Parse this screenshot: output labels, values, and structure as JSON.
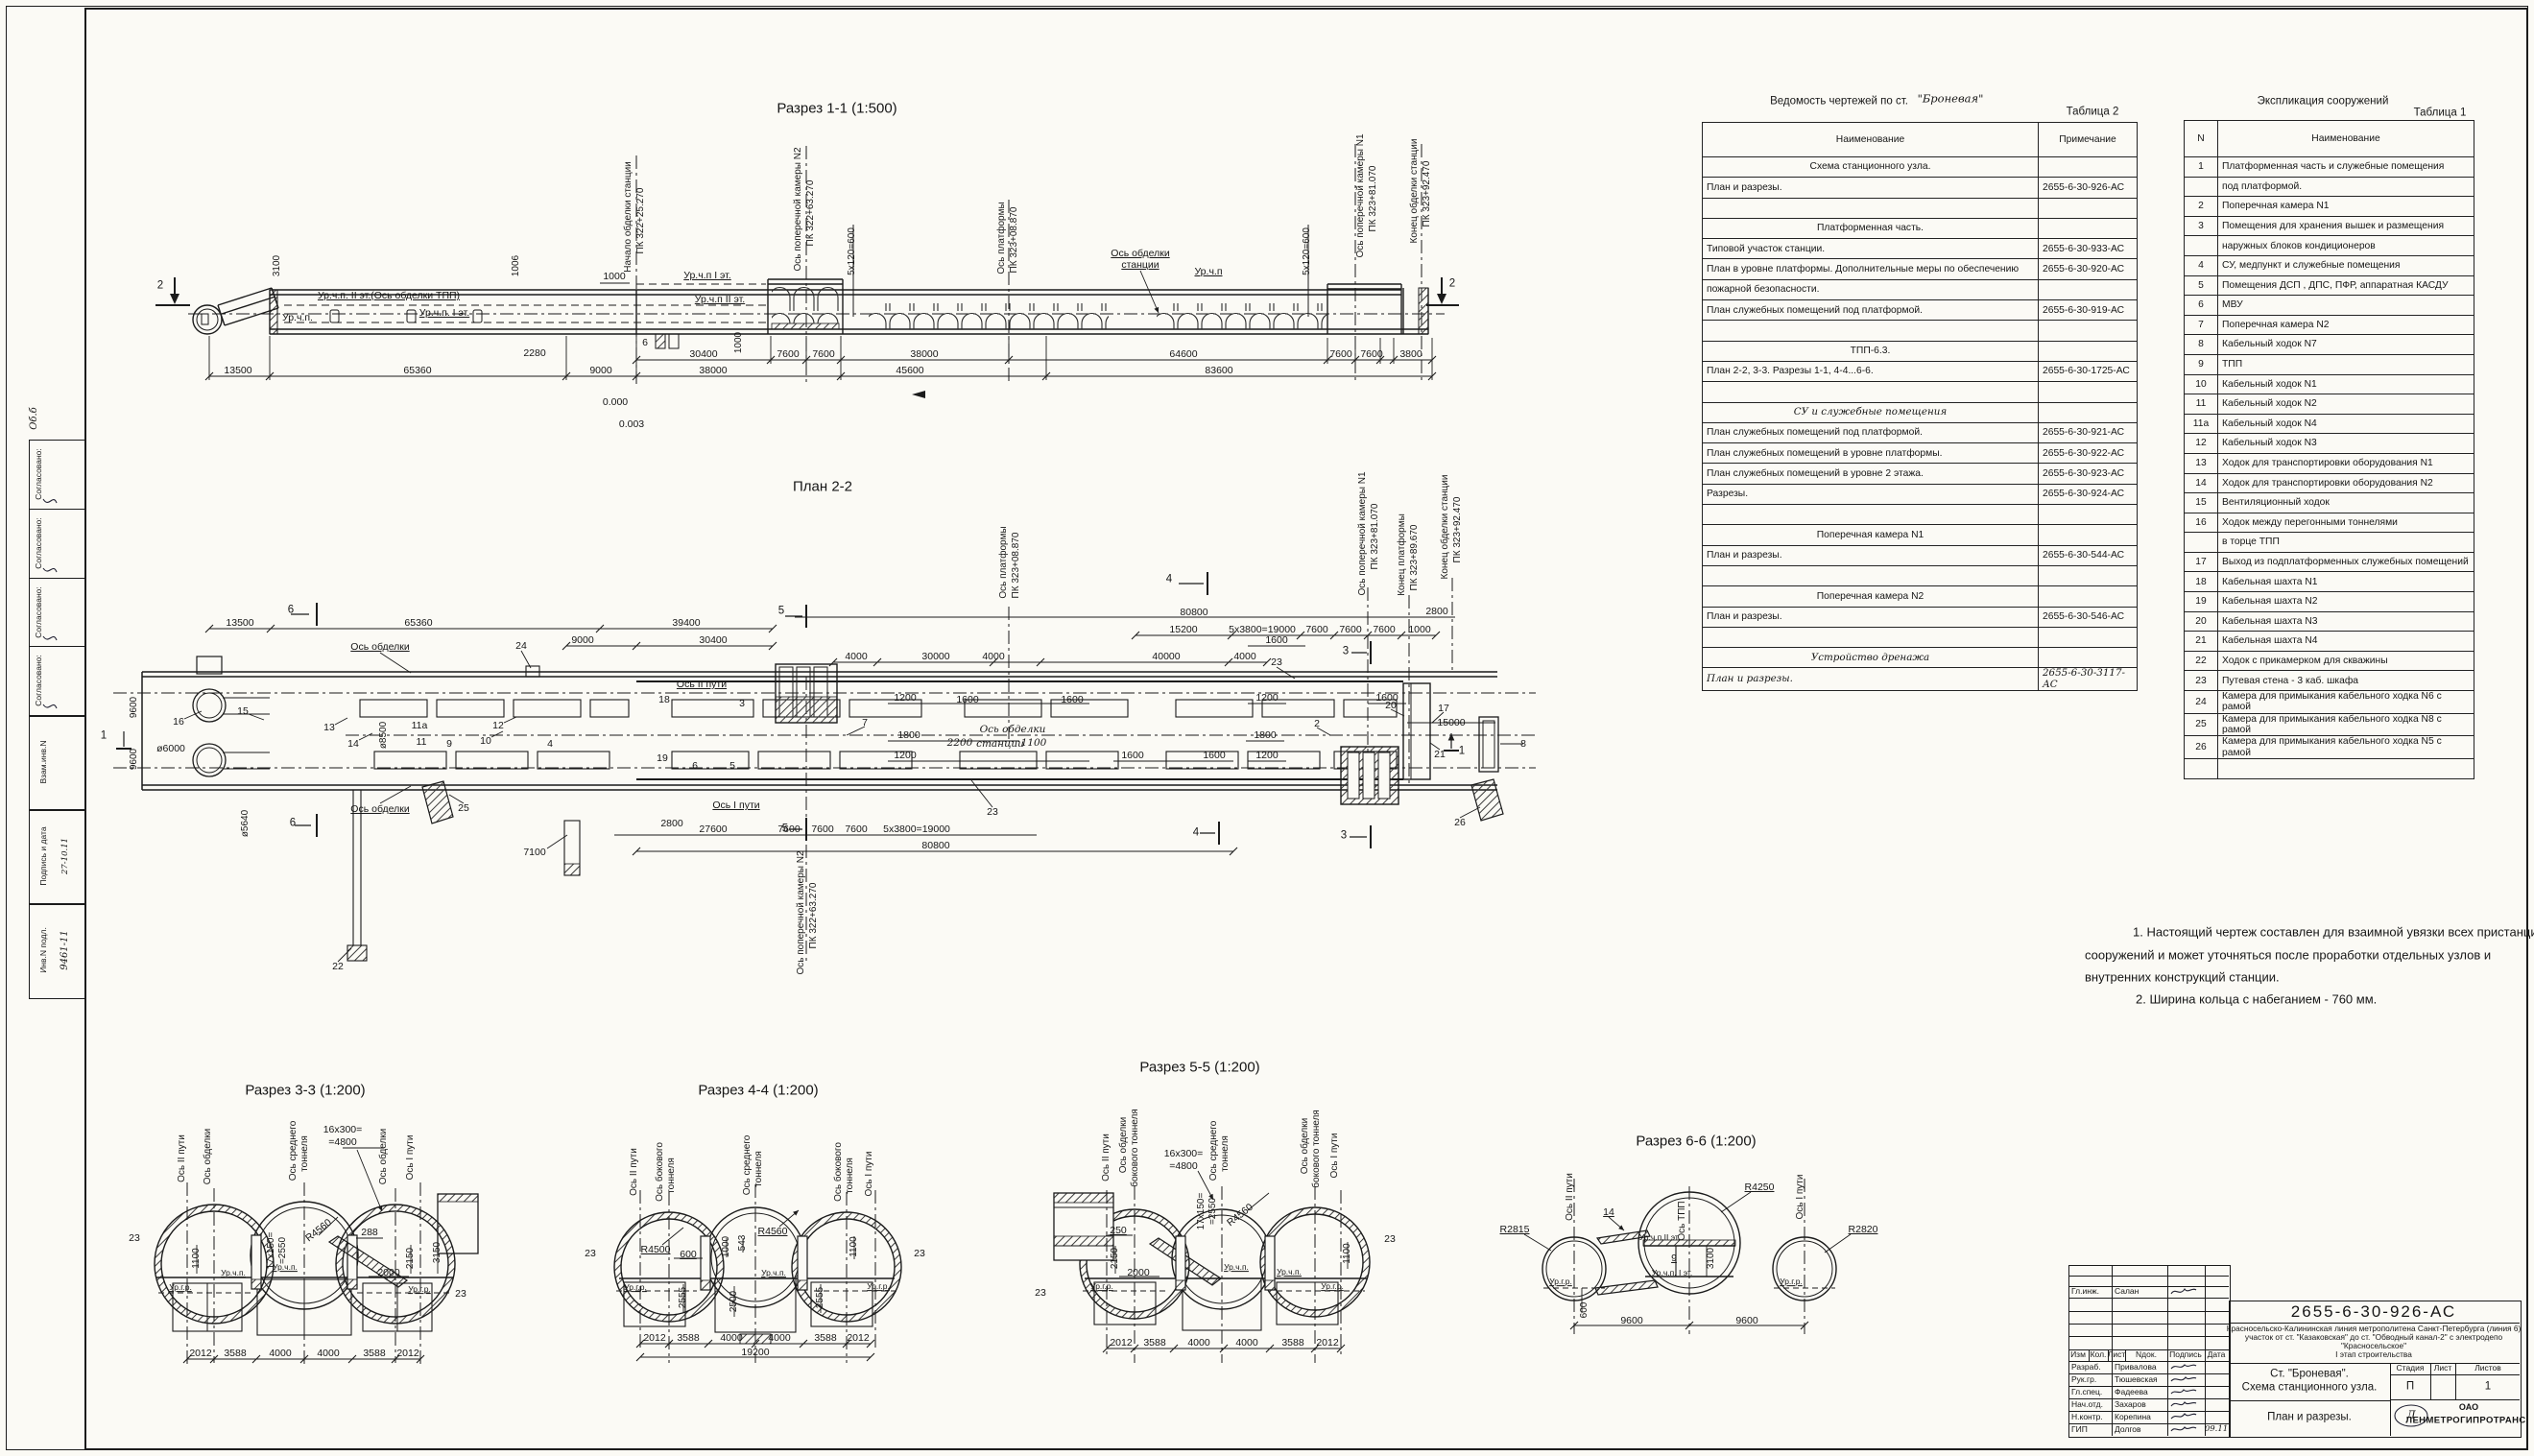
{
  "margin": {
    "agreed": "Согласовано:",
    "vzam": "Взам.инв.N",
    "sig": "Подпись и дата",
    "inv": "Инв.N подл.",
    "inv_no": "9461-11",
    "sig_date": "27-10.11",
    "scr": "Об.б"
  },
  "s11": {
    "t": "Разрез 1-1 (1:500)",
    "l": [
      "2",
      "2",
      "Ур.ч.п. II эт.(Ось обделки ТПП)",
      "Ур.ч.п.",
      "Ур.ч.п. I эт.",
      "Ур.ч.п I эт.",
      "Ур.ч.п II эт.",
      "6",
      "Ось обделки",
      "станции",
      "Ур.ч.п",
      "0.000",
      "0.003",
      "1000",
      "2280"
    ],
    "v": [
      "3100",
      "1006",
      "Начало обделки станции",
      "ПК 322+25.270",
      "Ось поперечной камеры N2",
      "ПК 322+63.270",
      "5х120=600",
      "Ось платформы",
      "ПК 323+08.870",
      "1000",
      "5х120=600",
      "Ось поперечной камеры N1",
      "ПК 323+81.070",
      "Конец обделки станции",
      "ПК 323+92.470"
    ],
    "du": [
      "30400",
      "7600",
      "7600",
      "38000",
      "64600",
      "7600",
      "7600",
      "3800"
    ],
    "dl": [
      "13500",
      "65360",
      "9000",
      "38000",
      "45600",
      "83600"
    ]
  },
  "p22": {
    "t": "План 2-2",
    "cut": [
      "6",
      "6",
      "5",
      "5",
      "4",
      "4",
      "3",
      "3",
      "1",
      "1"
    ],
    "n": [
      "16",
      "15",
      "13",
      "14",
      "11а",
      "11",
      "9",
      "12",
      "10",
      "4",
      "24",
      "25",
      "22",
      "18",
      "19",
      "6",
      "5",
      "3",
      "7",
      "23",
      "23",
      "20",
      "17",
      "2",
      "21",
      "26",
      "8"
    ],
    "l": [
      "Ось обделки",
      "Ось обделки",
      "Ось II пути",
      "Ось I пути",
      "ø6000",
      "7100",
      "15000"
    ],
    "h": [
      "Ось  обделки",
      "станции",
      "2200",
      "1100"
    ],
    "v": [
      "9600",
      "9600",
      "ø5640",
      "ø8500",
      "Ось платформы",
      "ПК 323+08.870",
      "Ось поперечной камеры N1",
      "ПК 323+81.070",
      "Конец платформы",
      "ПК 323+89.670",
      "Конец обделки станции",
      "ПК 323+92.470",
      "Ось поперечной камеры N2",
      "ПК 322+63.270"
    ],
    "d0": [
      "80800",
      "2800"
    ],
    "d1": [
      "13500",
      "65360",
      "39400",
      "15200",
      "5х3800=19000",
      "7600",
      "7600",
      "7600",
      "1000"
    ],
    "d2": [
      "9000",
      "30400",
      "1600"
    ],
    "d3": [
      "4000",
      "30000",
      "4000",
      "40000",
      "4000"
    ],
    "d4": [
      "1200",
      "1600",
      "1600",
      "1200",
      "1600"
    ],
    "d5": [
      "1800",
      "1800"
    ],
    "d6": [
      "1200",
      "1600",
      "1600",
      "1200"
    ],
    "d7": [
      "2800",
      "27600",
      "7600",
      "7600",
      "7600",
      "5х3800=19000",
      "80800"
    ]
  },
  "s33": {
    "t": "Разрез 3-3 (1:200)",
    "v": [
      "Ось II пути",
      "Ось обделки",
      "Ось среднего",
      "тоннеля",
      "Ось обделки",
      "Ось I пути",
      "1100",
      "17х150=",
      "=2550",
      "2150",
      "3150"
    ],
    "l": [
      "16х300=",
      "=4800",
      "R4560",
      "288",
      "2000",
      "Ур.ч.п.",
      "Ур.ч.п.",
      "Ур.г.р.",
      "Ур.г.р.",
      "23",
      "23"
    ],
    "d": [
      "2012",
      "3588",
      "4000",
      "4000",
      "3588",
      "2012"
    ]
  },
  "s44": {
    "t": "Разрез 4-4 (1:200)",
    "v": [
      "Ось II пути",
      "Ось бокового",
      "тоннеля",
      "Ось среднего",
      "тоннеля",
      "Ось бокового",
      "тоннеля",
      "Ось I пути",
      "1000",
      "543",
      "1100",
      "2555",
      "2500",
      "2555"
    ],
    "l": [
      "R4500",
      "600",
      "R4560",
      "Ур.г.р.",
      "Ур.г.р.",
      "Ур.ч.п.",
      "23",
      "23"
    ],
    "d": [
      "2012",
      "3588",
      "4000",
      "4000",
      "3588",
      "2012"
    ],
    "d2": [
      "19200"
    ]
  },
  "s55": {
    "t": "Разрез 5-5 (1:200)",
    "v": [
      "Ось II пути",
      "Ось обделки",
      "бокового тоннеля",
      "Ось среднего",
      "тоннеля",
      "Ось обделки",
      "бокового тоннеля",
      "Ось I пути",
      "17х150=",
      "=2550",
      "2150",
      "1100"
    ],
    "l": [
      "16х300=",
      "=4800",
      "R4560",
      "250",
      "2000",
      "Ур.г.р.",
      "Ур.ч.п.",
      "Ур.ч.п.",
      "Ур.г.р.",
      "23",
      "23"
    ],
    "d": [
      "2012",
      "3588",
      "4000",
      "4000",
      "3588",
      "2012"
    ]
  },
  "s66": {
    "t": "Разрез 6-6 (1:200)",
    "v": [
      "Ось II пути",
      "Ось ТПП",
      "Ось I пути",
      "3100",
      "600"
    ],
    "l": [
      "R2815",
      "14",
      "R4250",
      "R2820",
      "Ур.ч.п.II эт.",
      "9",
      "Ур.ч.п. I эт.",
      "Ур.г.р.",
      "Ур.г.р."
    ],
    "d": [
      "9600",
      "9600"
    ]
  },
  "table_sheets": {
    "title_prefix": "Ведомость чертежей по ст.",
    "title_station": "\"Броневая\"",
    "table_no": "Таблица 2",
    "col_name": "Наименование",
    "col_note": "Примечание",
    "rows": [
      {
        "name": "Схема станционного узла.",
        "note": "",
        "type": "sec"
      },
      {
        "name": "План и разрезы.",
        "note": "2655-6-30-926-АС",
        "type": ""
      },
      {
        "name": "",
        "note": "",
        "type": "emp"
      },
      {
        "name": "Платформенная часть.",
        "note": "",
        "type": "sec"
      },
      {
        "name": "Типовой участок станции.",
        "note": "2655-6-30-933-АС",
        "type": ""
      },
      {
        "name": "План в уровне платформы. Дополнительные меры по обеспечению",
        "note": "2655-6-30-920-АС",
        "type": ""
      },
      {
        "name": "пожарной безопасности.",
        "note": "",
        "type": ""
      },
      {
        "name": "План служебных помещений под платформой.",
        "note": "2655-6-30-919-АС",
        "type": ""
      },
      {
        "name": "",
        "note": "",
        "type": "emp"
      },
      {
        "name": "ТПП-6.3.",
        "note": "",
        "type": "sec"
      },
      {
        "name": "План 2-2, 3-3. Разрезы 1-1, 4-4...6-6.",
        "note": "2655-6-30-1725-АС",
        "type": ""
      },
      {
        "name": "",
        "note": "",
        "type": "emp"
      },
      {
        "name": "СУ и служебные помещения",
        "note": "",
        "type": "sec hand"
      },
      {
        "name": "План служебных помещений под платформой.",
        "note": "2655-6-30-921-АС",
        "type": ""
      },
      {
        "name": "План служебных помещений в уровне платформы.",
        "note": "2655-6-30-922-АС",
        "type": ""
      },
      {
        "name": "План служебных помещений в уровне 2 этажа.",
        "note": "2655-6-30-923-АС",
        "type": ""
      },
      {
        "name": "Разрезы.",
        "note": "2655-6-30-924-АС",
        "type": ""
      },
      {
        "name": "",
        "note": "",
        "type": "emp"
      },
      {
        "name": "Поперечная камера N1",
        "note": "",
        "type": "sec"
      },
      {
        "name": "План и разрезы.",
        "note": "2655-6-30-544-АС",
        "type": ""
      },
      {
        "name": "",
        "note": "",
        "type": "emp"
      },
      {
        "name": "Поперечная камера N2",
        "note": "",
        "type": "sec"
      },
      {
        "name": "План и разрезы.",
        "note": "2655-6-30-546-АС",
        "type": ""
      },
      {
        "name": "",
        "note": "",
        "type": "emp"
      },
      {
        "name": "Устройство дренажа",
        "note": "",
        "type": "sec hand"
      },
      {
        "name": "План и разрезы.",
        "note": "2655-6-30-3117-АС",
        "type": "hand"
      }
    ]
  },
  "table_structures": {
    "title": "Экспликация сооружений",
    "table_no": "Таблица 1",
    "col_n": "N",
    "col_name": "Наименование",
    "rows": [
      {
        "n": "1",
        "name": "Платформенная часть и служебные помещения"
      },
      {
        "n": "",
        "name": "под платформой."
      },
      {
        "n": "2",
        "name": "Поперечная камера N1"
      },
      {
        "n": "3",
        "name": "Помещения для хранения вышек и размещения"
      },
      {
        "n": "",
        "name": "наружных блоков кондиционеров"
      },
      {
        "n": "4",
        "name": "СУ, медпункт и служебные помещения"
      },
      {
        "n": "5",
        "name": "Помещения ДСП , ДПС, ПФР, аппаратная КАСДУ"
      },
      {
        "n": "6",
        "name": "МВУ"
      },
      {
        "n": "7",
        "name": "Поперечная камера N2"
      },
      {
        "n": "8",
        "name": "Кабельный ходок N7"
      },
      {
        "n": "9",
        "name": "ТПП"
      },
      {
        "n": "10",
        "name": "Кабельный ходок N1"
      },
      {
        "n": "11",
        "name": "Кабельный ходок N2"
      },
      {
        "n": "11а",
        "name": "Кабельный ходок N4"
      },
      {
        "n": "12",
        "name": "Кабельный ходок N3"
      },
      {
        "n": "13",
        "name": "Ходок для транспортировки оборудования N1"
      },
      {
        "n": "14",
        "name": "Ходок для транспортировки оборудования N2"
      },
      {
        "n": "15",
        "name": "Вентиляционный ходок"
      },
      {
        "n": "16",
        "name": "Ходок между перегонными тоннелями"
      },
      {
        "n": "",
        "name": "в торце ТПП"
      },
      {
        "n": "17",
        "name": "Выход из подплатформенных служебных помещений"
      },
      {
        "n": "18",
        "name": "Кабельная шахта N1"
      },
      {
        "n": "19",
        "name": "Кабельная шахта N2"
      },
      {
        "n": "20",
        "name": "Кабельная шахта N3"
      },
      {
        "n": "21",
        "name": "Кабельная шахта N4"
      },
      {
        "n": "22",
        "name": "Ходок с прикамерком для скважины"
      },
      {
        "n": "23",
        "name": "Путевая стена - 3 каб. шкафа"
      },
      {
        "n": "24",
        "name": "Камера для примыкания кабельного ходка N6 с рамой"
      },
      {
        "n": "25",
        "name": "Камера для примыкания кабельного ходка N8 с рамой"
      },
      {
        "n": "26",
        "name": "Камера для примыкания кабельного ходка N5 с рамой"
      },
      {
        "n": "",
        "name": ""
      }
    ]
  },
  "notes": {
    "n1": "1. Настоящий чертеж составлен для взаимной увязки всех пристанционных",
    "n2": "сооружений и может уточняться после проработки отдельных узлов и",
    "n3": "внутренних конструкций станции.",
    "n4": "2. Ширина кольца с набеганием - 760 мм."
  },
  "tb": {
    "doc_number": "2655-6-30-926-АС",
    "project_line1": "Красносельско-Калининская линия метрополитена Санкт-Петербурга (линия 6)",
    "project_line2": "участок от ст. \"Казаковская\" до ст. \"Обводный канал-2\" с электродепо",
    "project_line3": "\"Красносельское\"",
    "project_line4": "I этап строительства",
    "object_line1": "Ст. \"Броневая\".",
    "object_line2": "Схема станционного узла.",
    "sheet_name": "План и разрезы.",
    "stage_label": "Стадия",
    "sheet_label": "Лист",
    "sheets_label": "Листов",
    "stage_value": "П",
    "sheets_value": "1",
    "company_prefix": "ОАО",
    "company": "ЛЕНМЕТРОГИПРОТРАНС",
    "logo_letter": "Л",
    "date1": "09.11",
    "header": [
      "Изм",
      "Кол.",
      "Лист",
      "Nдок.",
      "Подпись",
      "Дата"
    ],
    "chief": {
      "role": "Гл.инж.",
      "name": "Салан"
    },
    "signers": [
      {
        "role": "Разраб.",
        "name": "Привалова"
      },
      {
        "role": "Рук.гр.",
        "name": "Тюшевская"
      },
      {
        "role": "Гл.спец.",
        "name": "Фадеева"
      },
      {
        "role": "Нач.отд.",
        "name": "Захаров"
      },
      {
        "role": "Н.контр.",
        "name": "Корепина"
      },
      {
        "role": "ГИП",
        "name": "Долгов"
      }
    ]
  }
}
